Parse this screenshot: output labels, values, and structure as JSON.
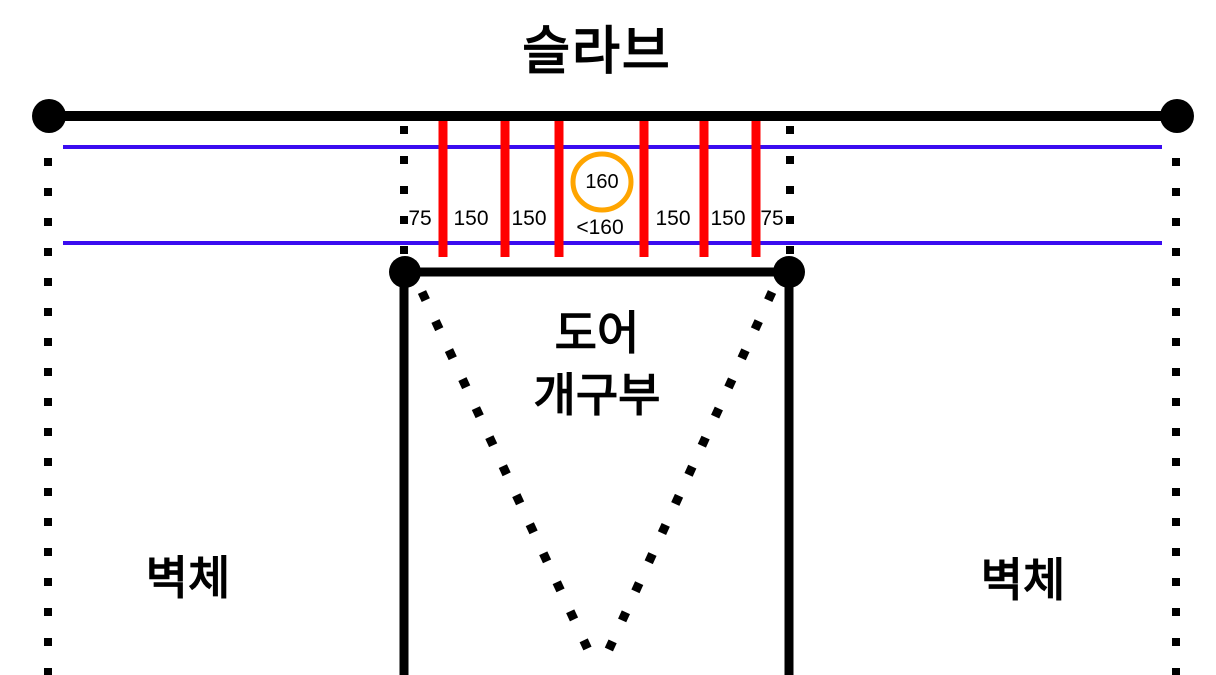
{
  "diagram": {
    "title": "슬라브",
    "door_opening": {
      "line1": "도어",
      "line2": "개구부"
    },
    "wall_left": "벽체",
    "wall_right": "벽체",
    "spacing_circle_value": "160",
    "spacings": [
      "75",
      "150",
      "150",
      "<160",
      "150",
      "150",
      "75"
    ],
    "colors": {
      "rebar": "#FF0000",
      "guide_line": "#3A0CF0",
      "highlight_circle": "#FFA500",
      "structure": "#000000"
    }
  }
}
